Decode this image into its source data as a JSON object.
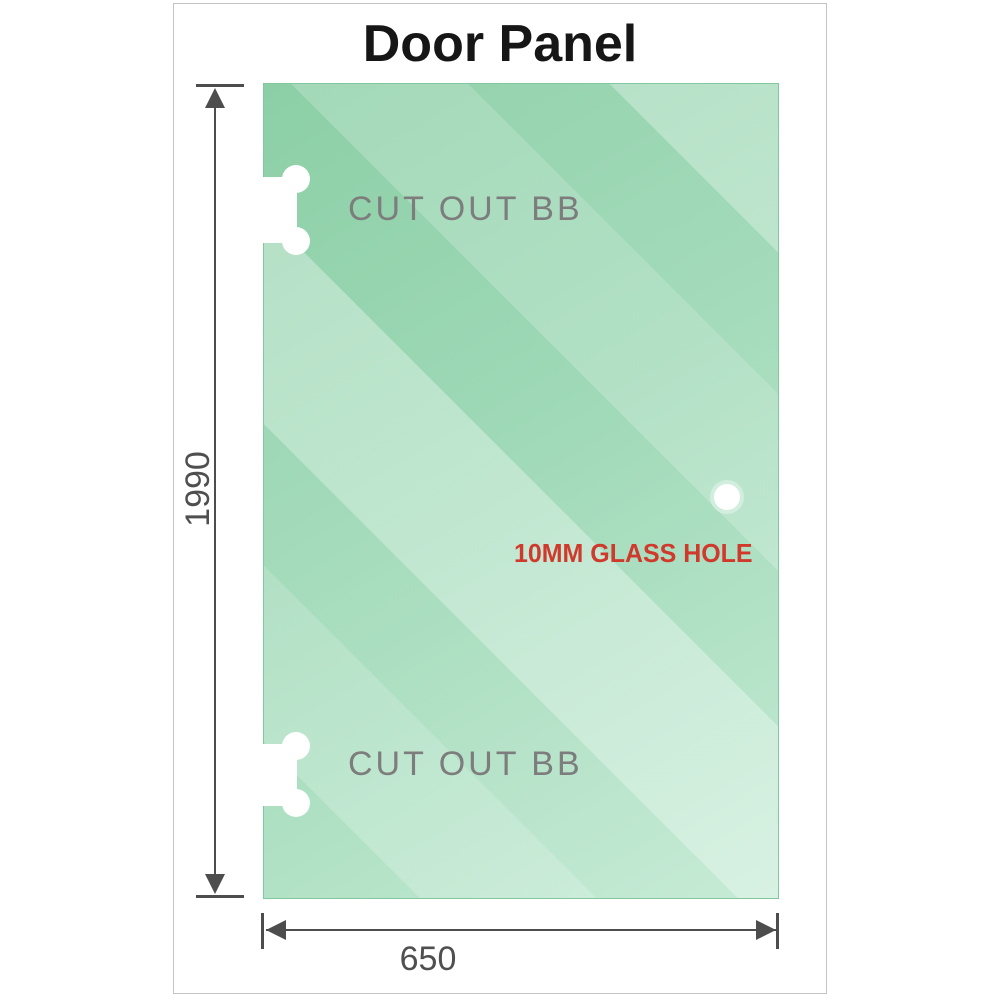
{
  "title": "Door Panel",
  "panel": {
    "cutouts": [
      {
        "label": "CUT OUT BB",
        "position": "top-left"
      },
      {
        "label": "CUT OUT BB",
        "position": "bottom-left"
      }
    ],
    "hole": {
      "label": "10MM GLASS HOLE"
    }
  },
  "dimensions": {
    "height": {
      "value": "1990",
      "unit": "mm"
    },
    "width": {
      "value": "650",
      "unit": "mm"
    }
  },
  "colors": {
    "glass_green": "#9bd7b3",
    "glass_edge": "#82c79e",
    "dimension_gray": "#4d4d4d",
    "label_gray": "#7d7d7d",
    "hole_label_red": "#cf3a2d",
    "frame_gray": "#c4c4c4"
  }
}
